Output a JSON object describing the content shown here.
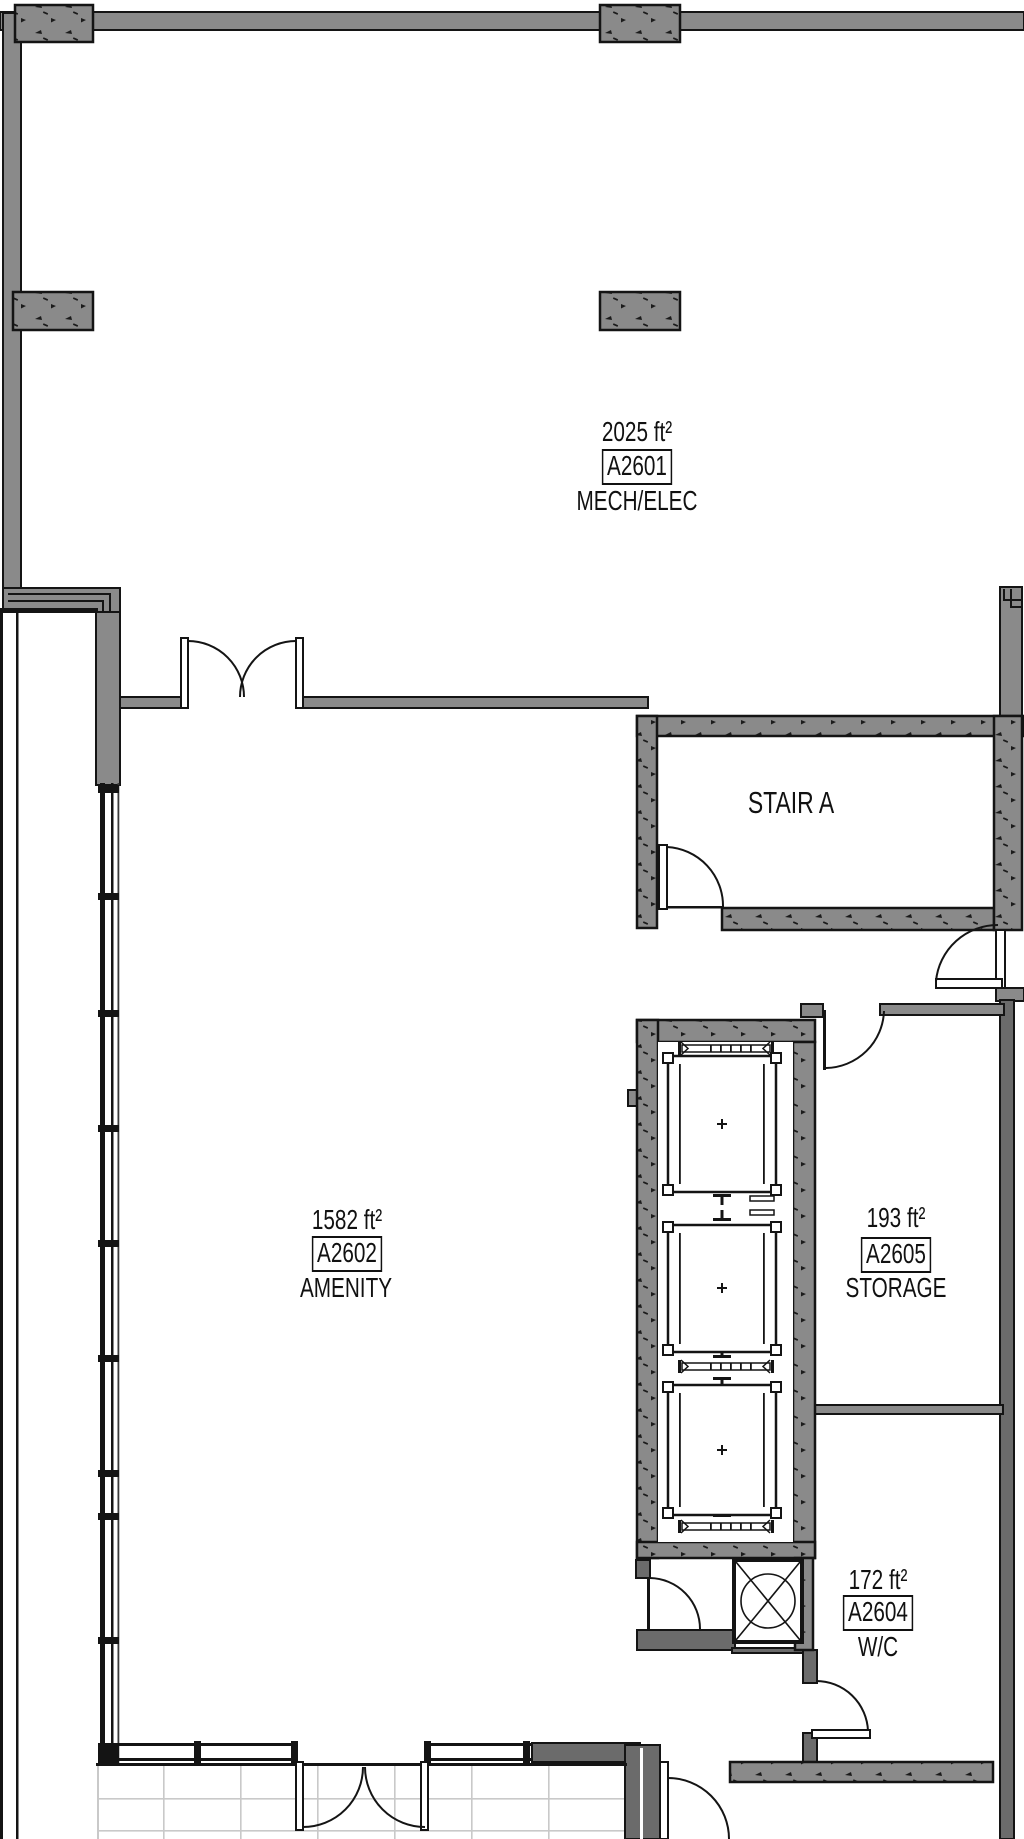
{
  "drawing_type": "architectural floor plan",
  "rooms": {
    "mech_elec": {
      "area": "2025 ft²",
      "id": "A2601",
      "name": "MECH/ELEC"
    },
    "amenity": {
      "area": "1582 ft²",
      "id": "A2602",
      "name": "AMENITY"
    },
    "storage": {
      "area": "193 ft²",
      "id": "A2605",
      "name": "STORAGE"
    },
    "wc": {
      "area": "172 ft²",
      "id": "A2604",
      "name": "W/C"
    },
    "stair": {
      "name": "STAIR A"
    }
  },
  "colors": {
    "wall_gray": "#8a8a8a",
    "wall_dark": "#6b6b6b",
    "line": "#141414",
    "tile_line": "#c9c9c9",
    "background": "#ffffff"
  }
}
